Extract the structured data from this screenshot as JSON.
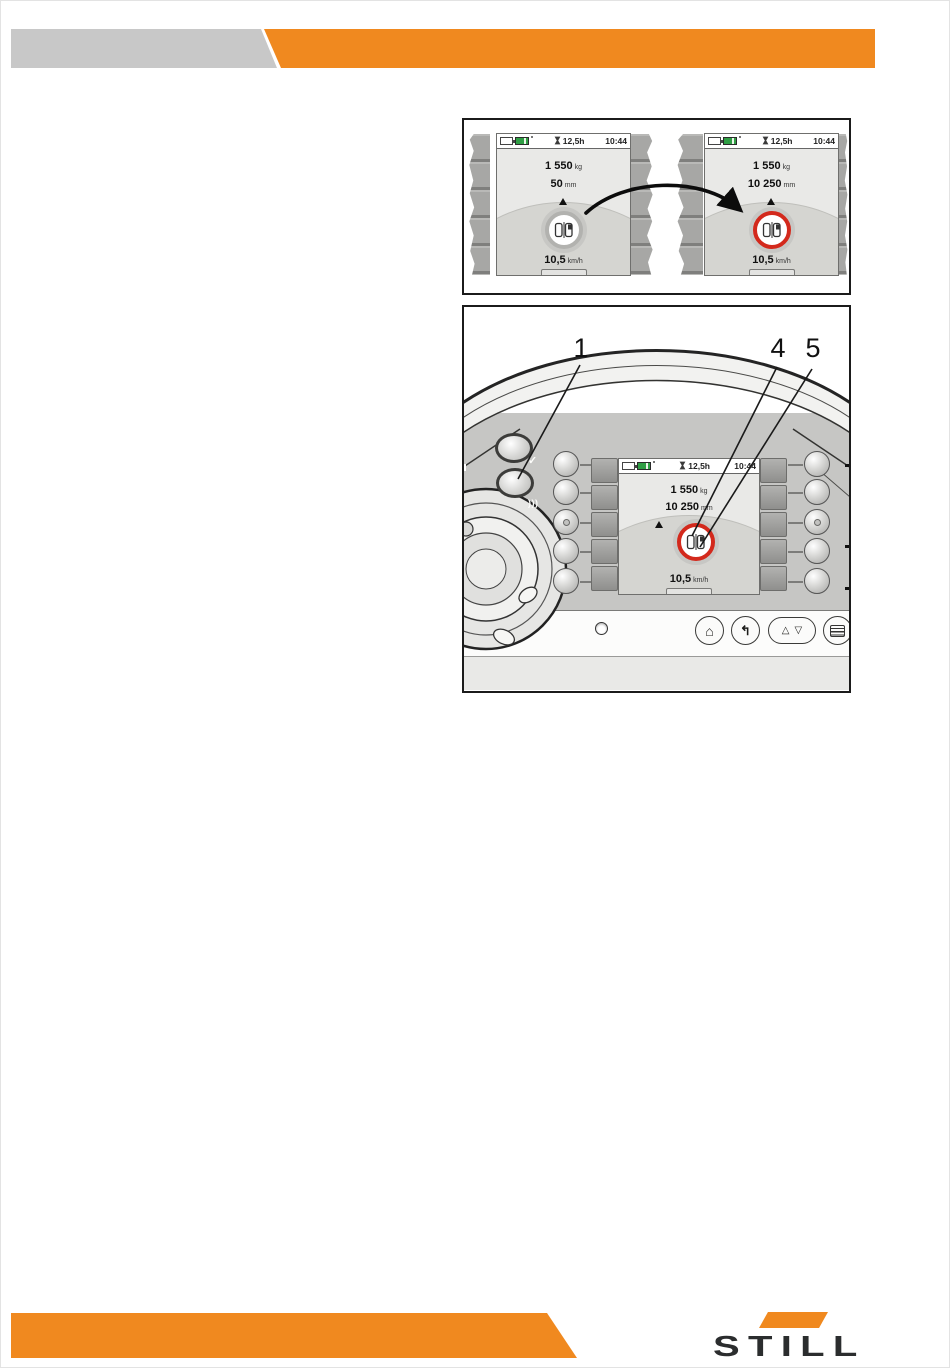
{
  "colors": {
    "orange": "#f0891f",
    "header_gray": "#c8c8c8",
    "ring_red": "#d3291c",
    "ring_gray": "#b2b2af",
    "battery_green": "#2f9e44"
  },
  "figure1": {
    "screens": [
      {
        "hours": "12,5h",
        "time": "10:44",
        "weight": "1 550",
        "weight_unit": "kg",
        "lift": "50",
        "lift_unit": "mm",
        "speed": "10,5",
        "speed_unit": "km/h"
      },
      {
        "hours": "12,5h",
        "time": "10:44",
        "weight": "1 550",
        "weight_unit": "kg",
        "lift": "10 250",
        "lift_unit": "mm",
        "speed": "10,5",
        "speed_unit": "km/h"
      }
    ]
  },
  "figure2": {
    "callouts": [
      "1",
      "4",
      "5"
    ],
    "screen": {
      "hours": "12,5h",
      "time": "10:44",
      "weight": "1 550",
      "weight_unit": "kg",
      "lift": "10 250",
      "lift_unit": "mm",
      "speed": "10,5",
      "speed_unit": "km/h"
    },
    "symbols": {
      "check": "✓",
      "blow": ")))",
      "home": "⌂",
      "back": "↰",
      "scroll_up": "△",
      "scroll_down": "▽"
    }
  },
  "footer": {
    "logo_text": "STILL"
  }
}
